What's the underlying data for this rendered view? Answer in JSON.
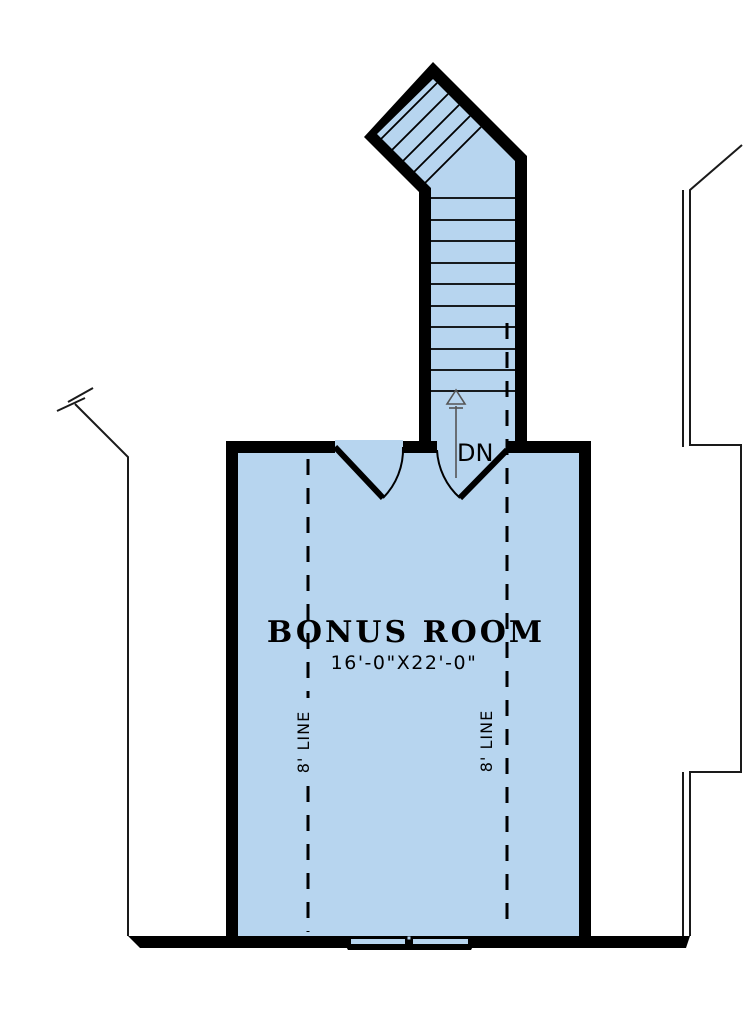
{
  "room": {
    "label": "BONUS ROOM",
    "dimensions": "16'-0\"X22'-0\""
  },
  "stairs": {
    "down_label": "DN"
  },
  "ceiling_lines": {
    "left_label": "8' LINE",
    "right_label": "8' LINE"
  },
  "colors": {
    "floor": "#b7d5ef",
    "wall": "#000000",
    "background": "#ffffff"
  }
}
